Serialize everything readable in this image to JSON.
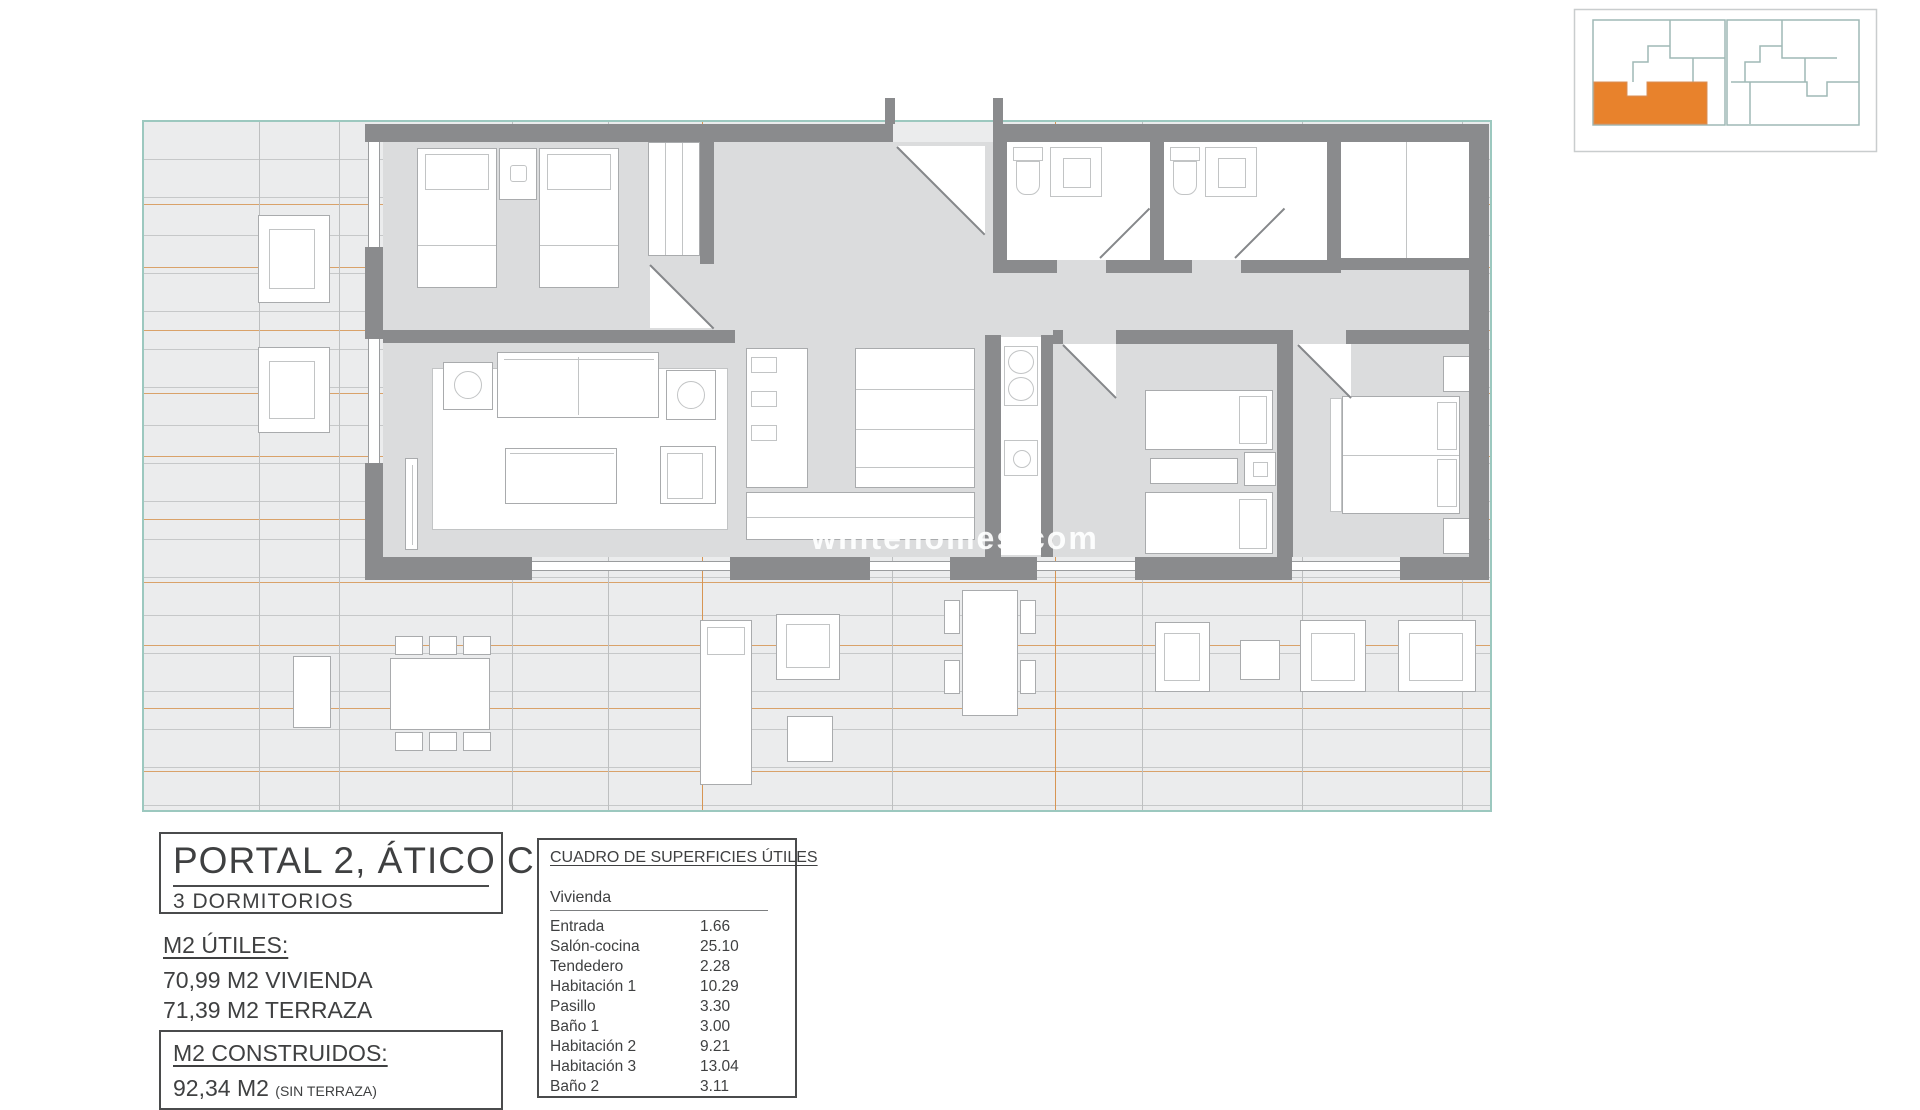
{
  "watermark": {
    "text": "whitehomes.com"
  },
  "key_plan": {
    "highlight_color": "#E8822C",
    "outline_color": "#9FB9B6"
  },
  "title_block": {
    "title": "PORTAL 2, ÁTICO C",
    "subtitle": "3 DORMITORIOS"
  },
  "m2_utiles": {
    "heading": "M2 ÚTILES:",
    "line1": "70,99 M2 VIVIENDA",
    "line2": "71,39 M2 TERRAZA"
  },
  "m2_construidos": {
    "heading": "M2 CONSTRUIDOS:",
    "value": "92,34 M2",
    "note": "(SIN TERRAZA)"
  },
  "areas_table": {
    "title": "CUADRO DE SUPERFICIES ÚTILES",
    "group": "Vivienda",
    "rows": [
      {
        "label": "Entrada",
        "value": "1.66"
      },
      {
        "label": "Salón-cocina",
        "value": "25.10"
      },
      {
        "label": "Tendedero",
        "value": "2.28"
      },
      {
        "label": "Habitación 1",
        "value": "10.29"
      },
      {
        "label": "Pasillo",
        "value": "3.30"
      },
      {
        "label": "Baño 1",
        "value": "3.00"
      },
      {
        "label": "Habitación 2",
        "value": "9.21"
      },
      {
        "label": "Habitación 3",
        "value": "13.04"
      },
      {
        "label": "Baño 2",
        "value": "3.11"
      }
    ]
  },
  "colors": {
    "accent_orange": "#E8822C",
    "teal_border": "#9CC8BF",
    "wall_gray": "#8A8B8D",
    "floor_gray": "#DBDCDD",
    "terrace_gray": "#EBECED",
    "deck_line_orange": "#D79553",
    "deck_line_gray": "#C6C8C9"
  }
}
